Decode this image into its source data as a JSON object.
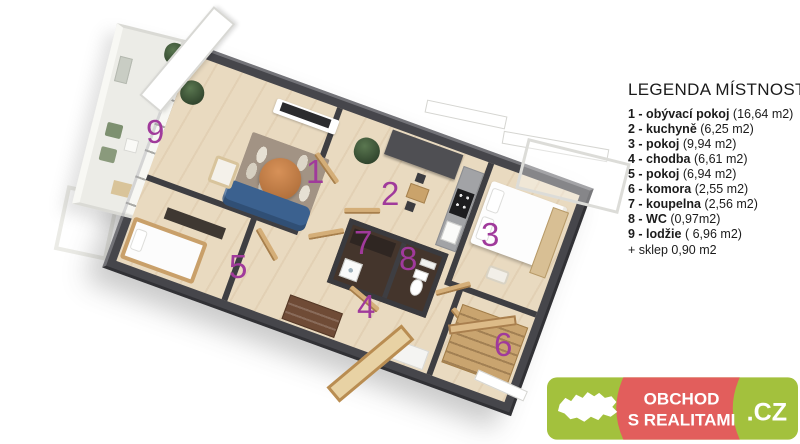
{
  "plan": {
    "room_labels": [
      "1",
      "2",
      "3",
      "4",
      "5",
      "6",
      "7",
      "8",
      "9"
    ],
    "number_color": "#a03a9b",
    "wall_color": "#3e3e42",
    "floor_color": "#e9dac0",
    "balcony_floor_color": "#ecece7"
  },
  "legend": {
    "title": "LEGENDA MÍSTNOSTÍ",
    "items": [
      {
        "label": "1 - obývací pokoj",
        "area": "(16,64 m2)"
      },
      {
        "label": "2 - kuchyně",
        "area": "(6,25 m2)"
      },
      {
        "label": "3 - pokoj",
        "area": "(9,94 m2)"
      },
      {
        "label": "4 - chodba",
        "area": "(6,61 m2)"
      },
      {
        "label": "5 - pokoj",
        "area": "(6,94 m2)"
      },
      {
        "label": "6 - komora",
        "area": "(2,55 m2)"
      },
      {
        "label": "7 - koupelna",
        "area": "(2,56 m2)"
      },
      {
        "label": "8 - WC",
        "area": "(0,97m2)"
      },
      {
        "label": "9 - lodžie",
        "area": "( 6,96 m2)"
      }
    ],
    "note": "+ sklep 0,90 m2"
  },
  "logo": {
    "line1": "OBCHOD",
    "line2": "S REALITAMI",
    "suffix": ".CZ",
    "colors": {
      "green": "#a3c13d",
      "red": "#e25e5c",
      "text": "#ffffff"
    }
  }
}
